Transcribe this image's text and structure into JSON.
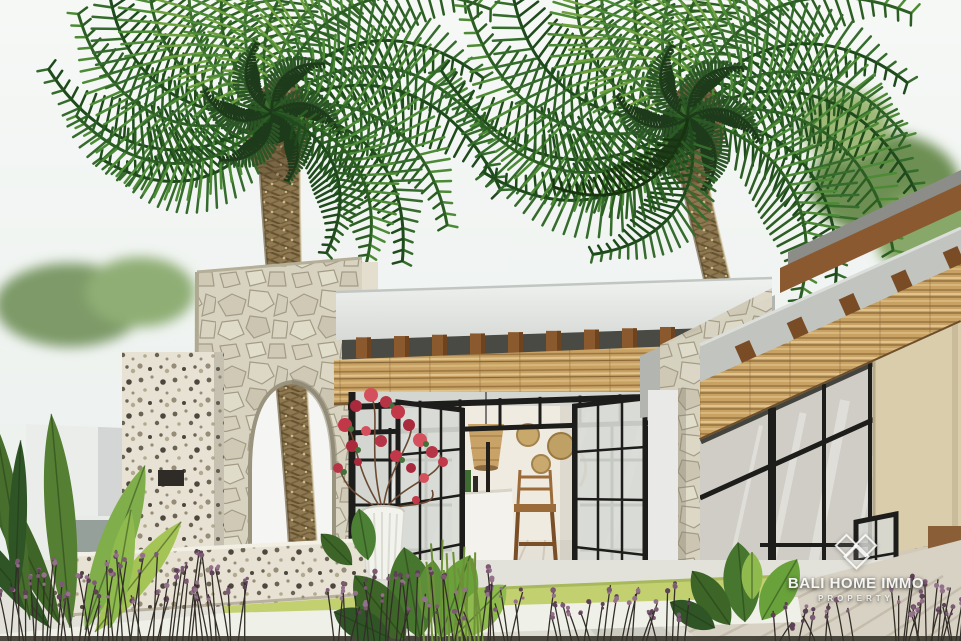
{
  "image": {
    "kind": "architectural exterior 3D render",
    "subject": "Tropical Bali-style villa courtyard with two coconut palm trees, a natural-stone archway, black steel-framed glass doors, bamboo pergola roofs, white planter with red bougainvillea and lush tropical landscaping",
    "width_px": 961,
    "height_px": 641
  },
  "watermark": {
    "brand": "BALI HOME IMMO",
    "tagline": "PROPERTY",
    "logo_icon": "three-diamonds-logo"
  },
  "palette": {
    "sky": "#f3f6f4",
    "palm_green_dark": "#2c5527",
    "palm_green_mid": "#3e7a33",
    "palm_green_light": "#6fa03c",
    "trunk_brown": "#8d7852",
    "stone_wall": "#d8d3c1",
    "terrazzo": "#e7e2d4",
    "white_wall": "#ebedeb",
    "wood_pergola": "#a9763f",
    "bamboo_light": "#d7b277",
    "steel_frame_black": "#1d1d1b",
    "glass_gray": "#d5d6d1",
    "grass_green": "#c3d070",
    "table_green": "#2fa35a",
    "beige_panel": "#d9cdab",
    "flower_red": "#c23848",
    "flower_purple": "#7d5a74"
  },
  "scene_elements": [
    "left-palm-tree",
    "right-palm-tree",
    "stone-archway",
    "terrazzo-pillar",
    "white-boundary-wall",
    "center-pavilion",
    "bamboo-pergola",
    "steel-glass-doors",
    "interior-bar-counter",
    "barstool",
    "rattan-pendant-lamp",
    "rattan-wall-plates",
    "right-wing-glass-facade",
    "green-table",
    "white-planter-bougainvillea",
    "monstera-plant",
    "banana-plants",
    "purple-flower-stems",
    "lawn-strip",
    "stone-deck"
  ]
}
